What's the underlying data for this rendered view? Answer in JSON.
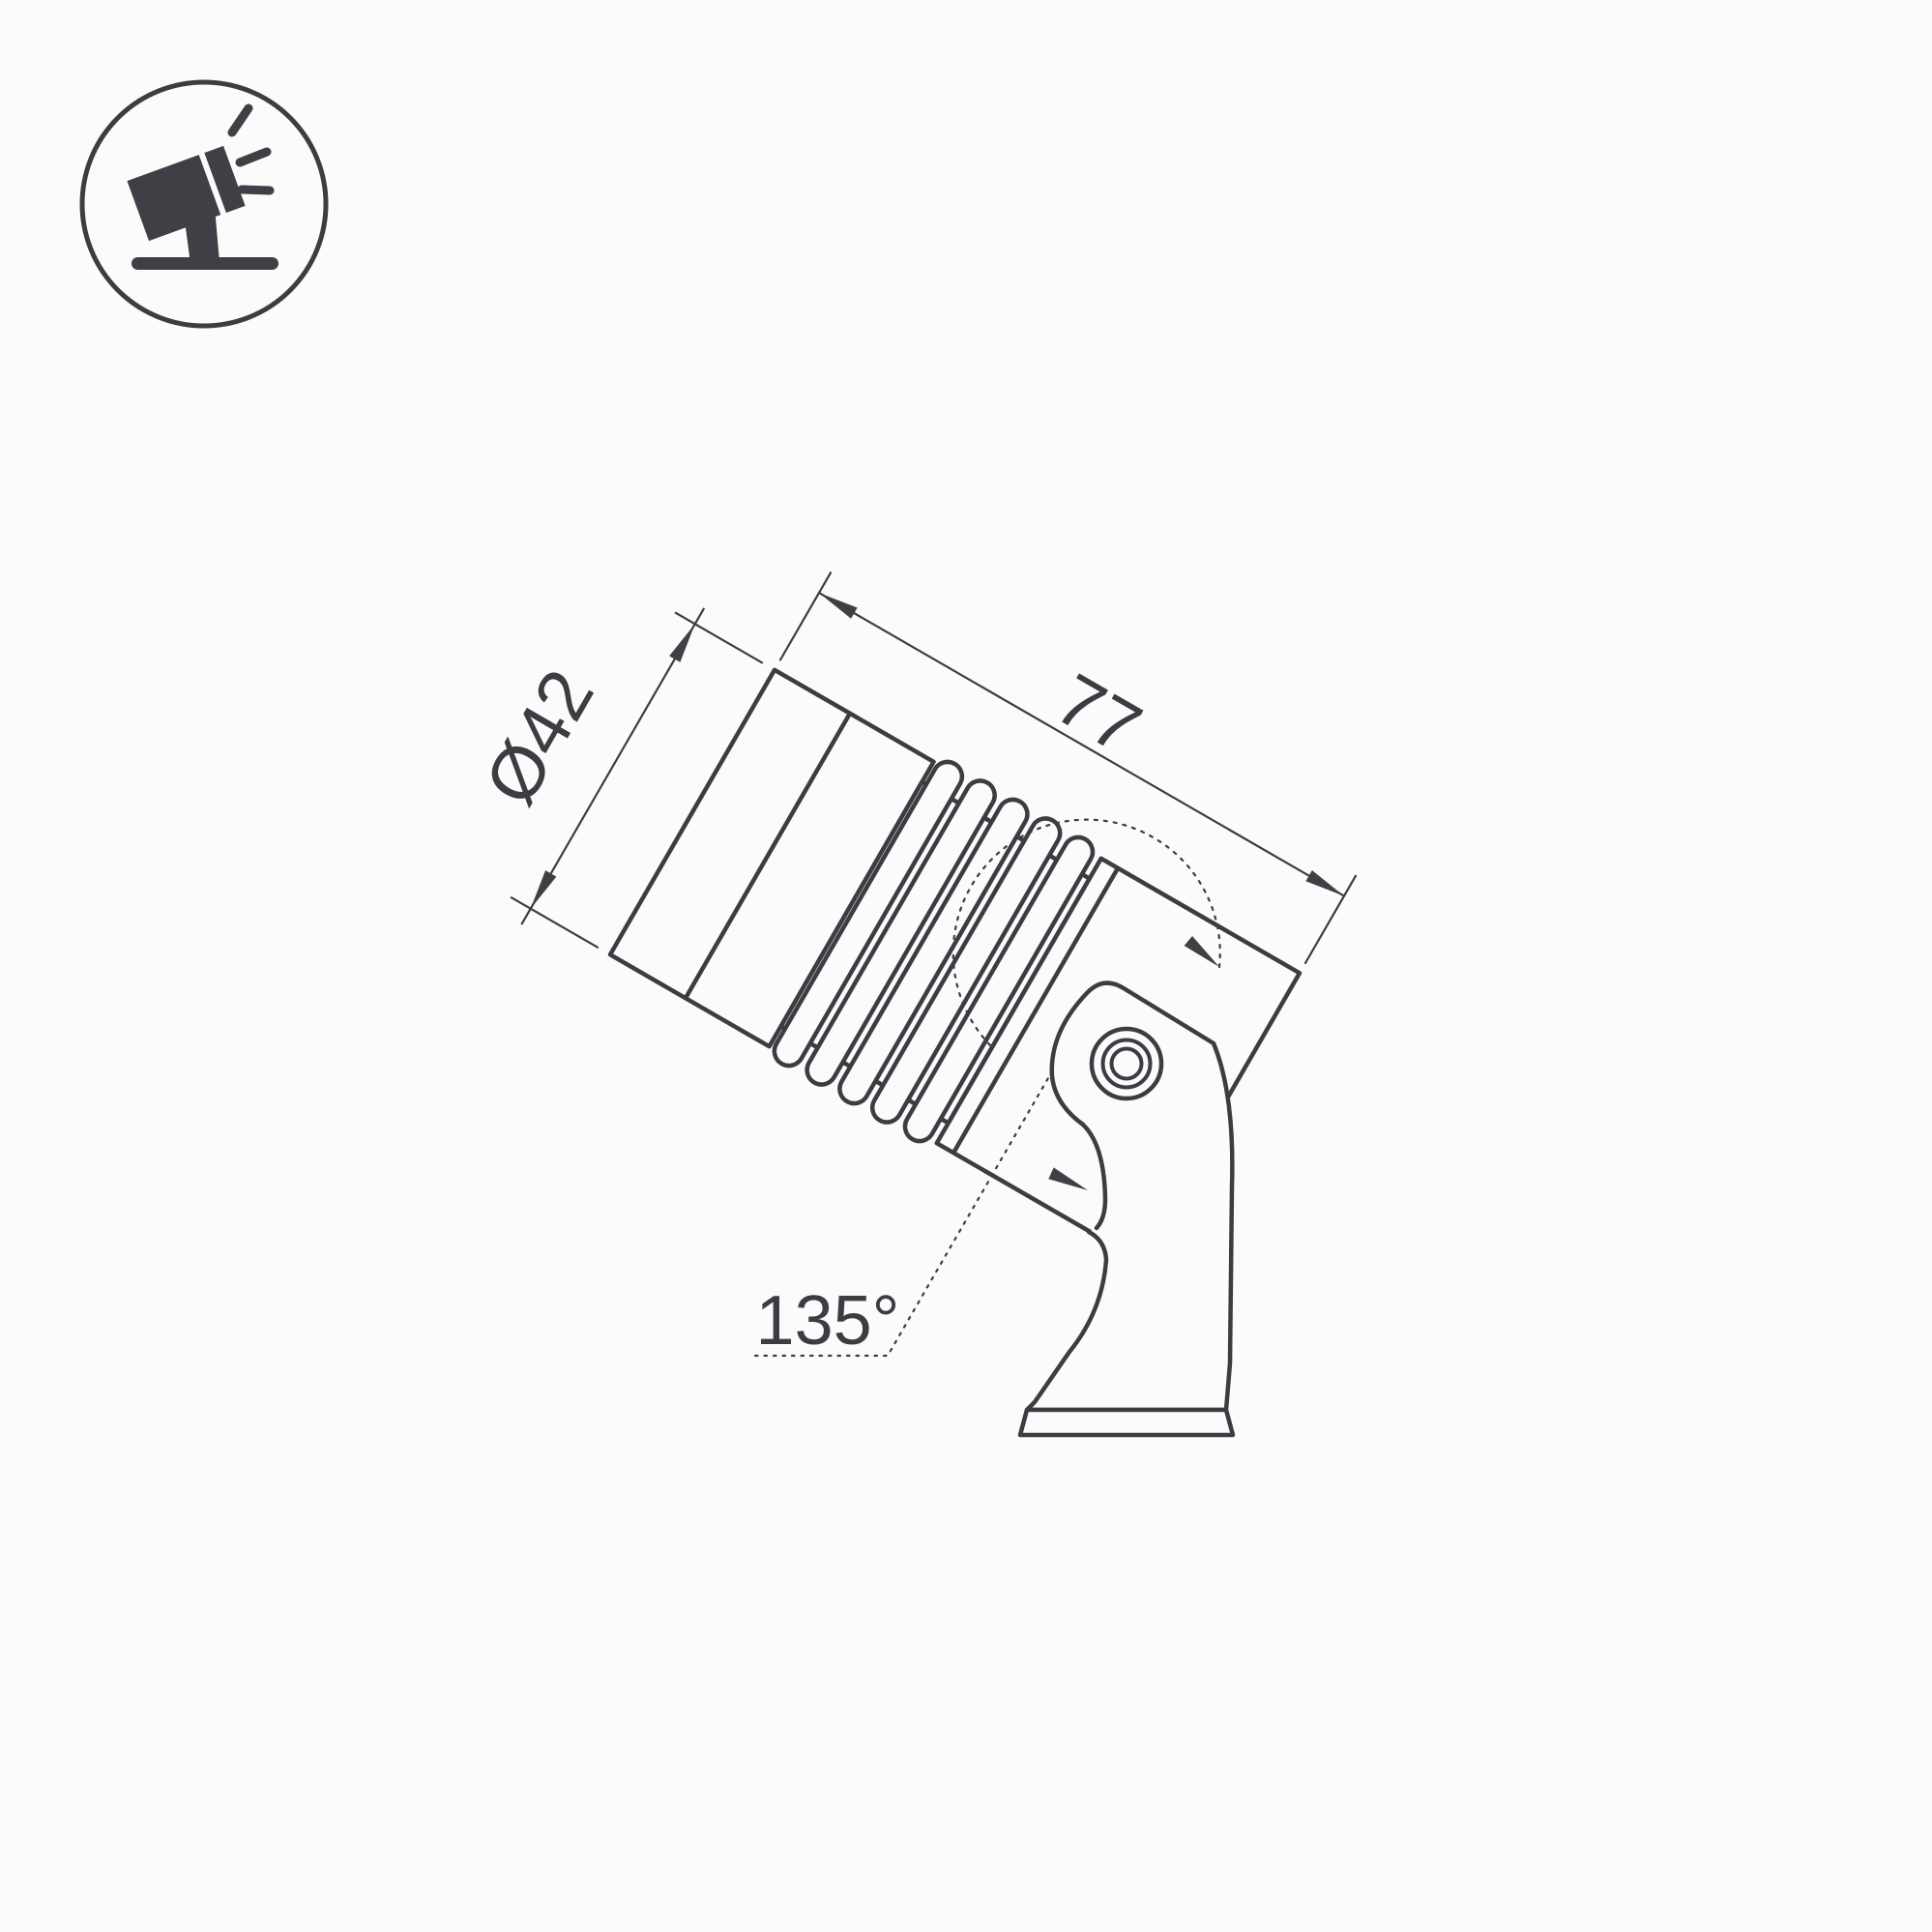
{
  "page": {
    "background": "#fbfbfb"
  },
  "colors": {
    "line": "#3b3d42",
    "fill_dark": "#3f4045",
    "text": "#3b3d42"
  },
  "icon": {
    "name": "tilted-spotlight-on-ground"
  },
  "labels": {
    "diameter": "Ø42",
    "length": "77",
    "swivel_angle": "135°"
  }
}
